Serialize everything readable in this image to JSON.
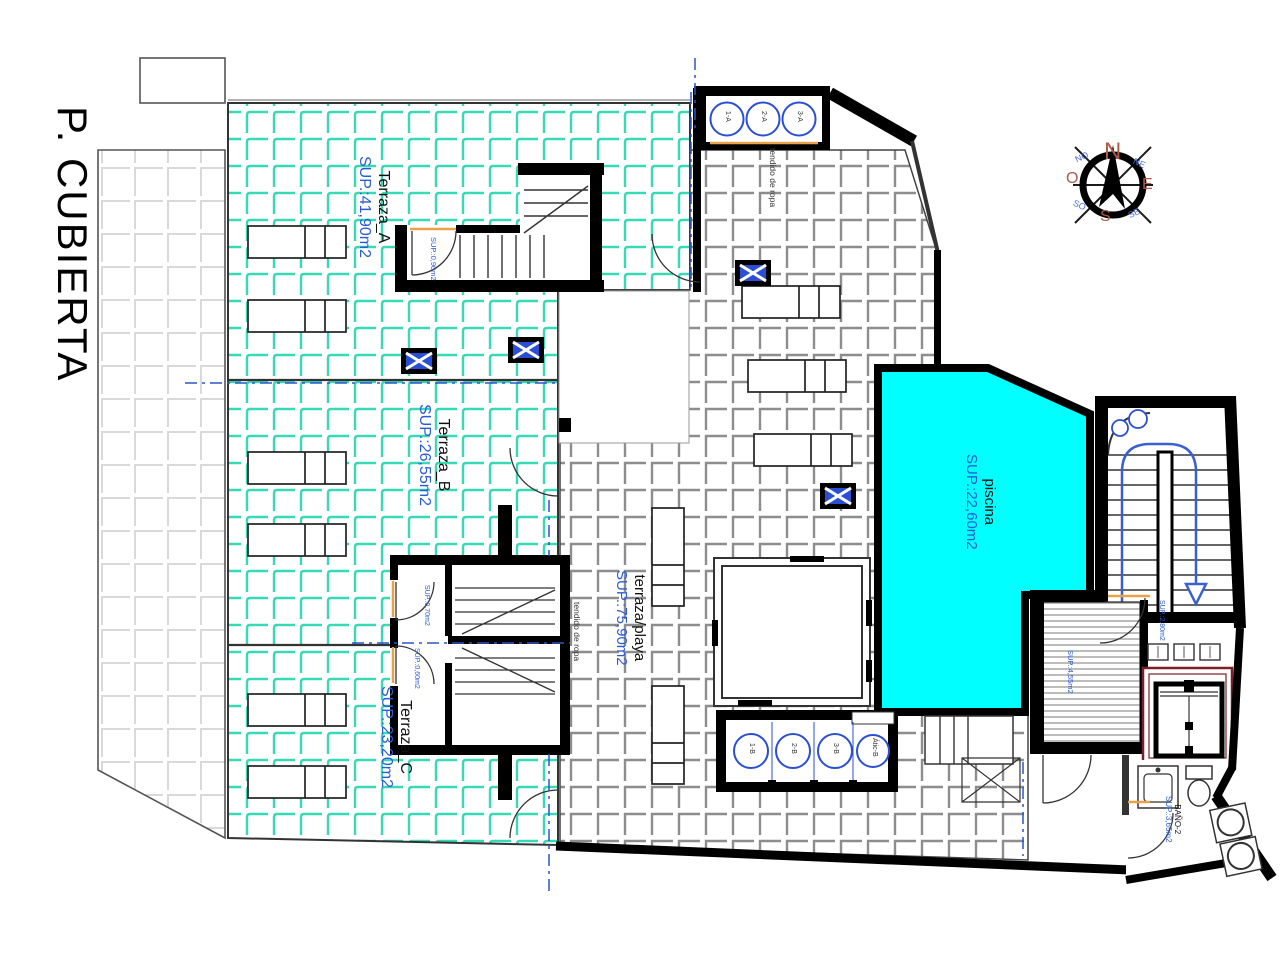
{
  "title": "P. CUBIERTA",
  "areas": {
    "terraza_a": {
      "name": "Terraza_A",
      "sup": "SUP.:41,90m2"
    },
    "terraza_b": {
      "name": "Terraza_B",
      "sup": "SUP.:26,55m2"
    },
    "terraza_c": {
      "name": "Terraza_C",
      "sup": "SUP.:23,20m2"
    },
    "terraza_playa": {
      "name": "terraza/playa",
      "sup": "SUP.:75,90m2"
    },
    "piscina": {
      "name": "piscina",
      "sup": "SUP.:22,60m2"
    },
    "bano_2": {
      "name": "BAÑO-2",
      "sup": "SUP.:3,65m2"
    }
  },
  "small_areas": {
    "closet_top": "SUP.:0,90m2",
    "closet_mid_1": "SUP.:0,70m2",
    "closet_mid_2": "SUP.:0,60m2",
    "stair_landing": "SUP.:2,80m2",
    "solarium": "SUP.:4,55m2"
  },
  "annotations": {
    "clothesline_top": "tendido de ropa",
    "clothesline_mid": "tendido de ropa"
  },
  "vents": {
    "top": [
      "1-A",
      "2-A",
      "3-A"
    ],
    "bottom": [
      "1-B",
      "2-B",
      "3-B",
      "Átic-B"
    ]
  },
  "compass": {
    "n": "N",
    "e": "E",
    "s": "S",
    "o": "O",
    "no": "NO",
    "ne": "NE",
    "so": "SO",
    "se": "SE"
  },
  "colors": {
    "terrace_tile": "#38d9b6",
    "pool": "#00ffff",
    "label_blue": "#2a5bd7",
    "vent_blue": "#2b4fd4",
    "threshold_orange": "#e8a24a",
    "elevator_maroon": "#7a1f2b",
    "compass_cardinal": "#b05a48",
    "compass_inter": "#4a6cd8"
  }
}
